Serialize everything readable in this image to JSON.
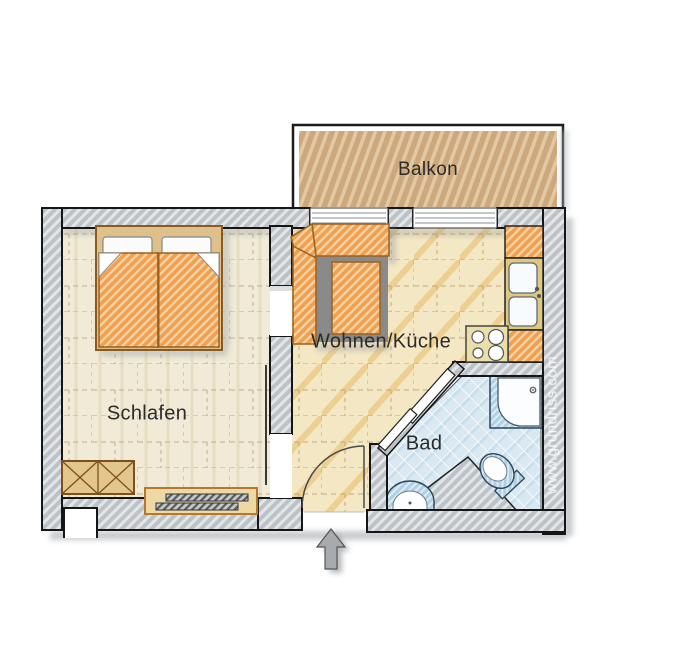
{
  "labels": {
    "balcony": "Balkon",
    "bedroom": "Schlafen",
    "living_kitchen": "Wohnen/Küche",
    "bathroom": "Bad"
  },
  "watermark": "www.grundriss.com",
  "fixtures": [
    "double-bed",
    "wardrobe",
    "radiator",
    "corner-sofa",
    "kitchen-counter",
    "kitchen-double-sink",
    "stove-4-burners",
    "corner-shower",
    "toilet",
    "washbasin",
    "sliding-door",
    "entrance-door",
    "entrance-arrow",
    "balcony"
  ],
  "stove_burner_count": 4,
  "colors": {
    "wall_gray": "#bfc5c9",
    "fabric_orange": "#f0a050",
    "balcony_tan": "#cfa87a",
    "bath_blue": "#d9e9f2",
    "floor_cream": "#f0ead6",
    "floor_tan": "#f5e9c8",
    "counter_yellow": "#ddc87f",
    "stove_cream": "#eadfab",
    "arrow_gray": "#a7abae"
  }
}
